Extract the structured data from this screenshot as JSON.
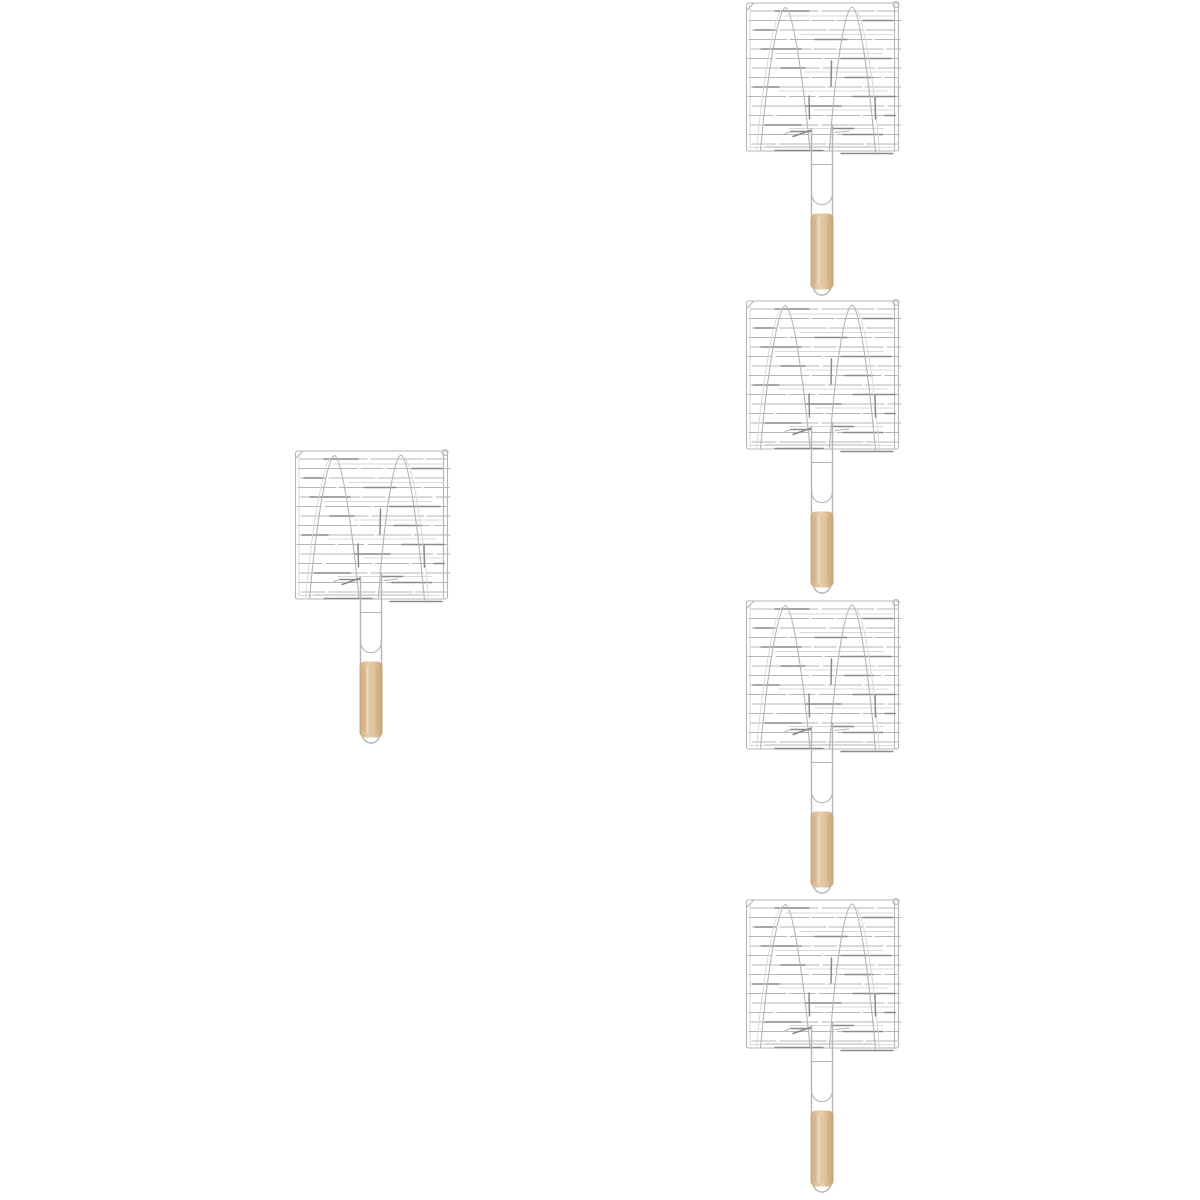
{
  "image": {
    "kind": "product-photo",
    "subject": "bbq-grill-basket-with-wooden-handle",
    "background": "#ffffff",
    "item_count": 5
  },
  "colors": {
    "wire": "#b5b5b5",
    "wire_dark": "#8a8a8a",
    "wire_echo": "#d9d9d9",
    "wood_edge": "#c9a67c",
    "wood_mid": "#dcbd97",
    "wood_light": "#e8d0ad",
    "wood_dark": "#c5a276"
  },
  "items": [
    {
      "id": "grill-basket-left",
      "x": 294,
      "y": 449
    },
    {
      "id": "grill-basket-right-1",
      "x": 745,
      "y": 1
    },
    {
      "id": "grill-basket-right-2",
      "x": 745,
      "y": 299
    },
    {
      "id": "grill-basket-right-3",
      "x": 745,
      "y": 599
    },
    {
      "id": "grill-basket-right-4",
      "x": 745,
      "y": 898
    }
  ]
}
